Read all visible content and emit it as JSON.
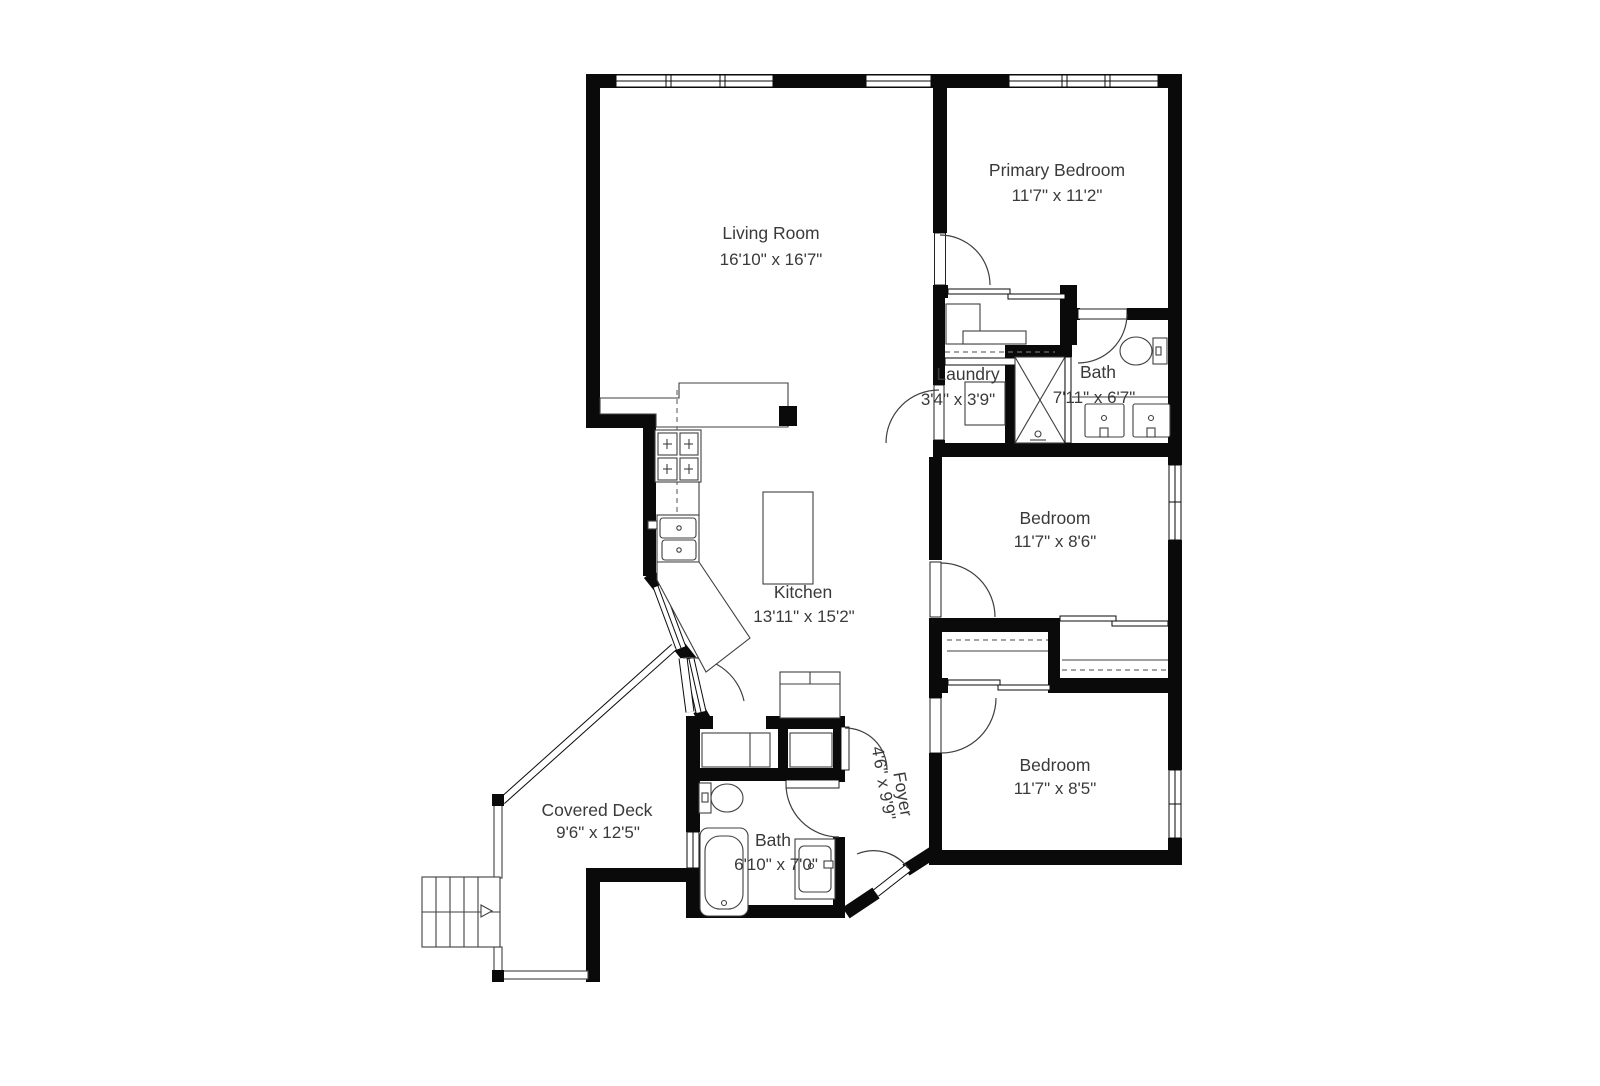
{
  "page": {
    "background": "#ffffff"
  },
  "plan": {
    "wall_color": "#0a0a0a",
    "fixture_line_color": "#3f3f3f",
    "text_color": "#3a3a3a",
    "rooms": [
      {
        "id": "living-room",
        "name": "Living Room",
        "dims": "16'10\" x 16'7\""
      },
      {
        "id": "primary-bedroom",
        "name": "Primary Bedroom",
        "dims": "11'7\" x 11'2\""
      },
      {
        "id": "laundry",
        "name": "Laundry",
        "dims": "3'4\" x 3'9\""
      },
      {
        "id": "bath-upper",
        "name": "Bath",
        "dims": "7'11\" x 6'7\""
      },
      {
        "id": "bedroom-middle",
        "name": "Bedroom",
        "dims": "11'7\" x 8'6\""
      },
      {
        "id": "kitchen",
        "name": "Kitchen",
        "dims": "13'11\" x 15'2\""
      },
      {
        "id": "bedroom-lower",
        "name": "Bedroom",
        "dims": "11'7\" x 8'5\""
      },
      {
        "id": "foyer",
        "name": "Foyer",
        "dims": "4'6\" x 9'9\""
      },
      {
        "id": "bath-lower",
        "name": "Bath",
        "dims": "6'10\" x 7'0\""
      },
      {
        "id": "covered-deck",
        "name": "Covered Deck",
        "dims": "9'6\" x 12'5\""
      }
    ],
    "fixtures": [
      "range-stove-icon",
      "kitchen-sink-icon",
      "kitchen-island-icon",
      "counter-peninsula-icon",
      "refrigerator-cabinet-icon",
      "washer-dryer-icon",
      "shower-icon",
      "toilet-icon",
      "double-sink-vanity-icon",
      "bathtub-icon",
      "sink-vanity-icon",
      "stairs-icon",
      "closet-rod-icon",
      "closet-shelf-icon",
      "sliding-closet-door-icon",
      "window-icon",
      "door-swing-icon",
      "deck-railing-icon"
    ]
  }
}
